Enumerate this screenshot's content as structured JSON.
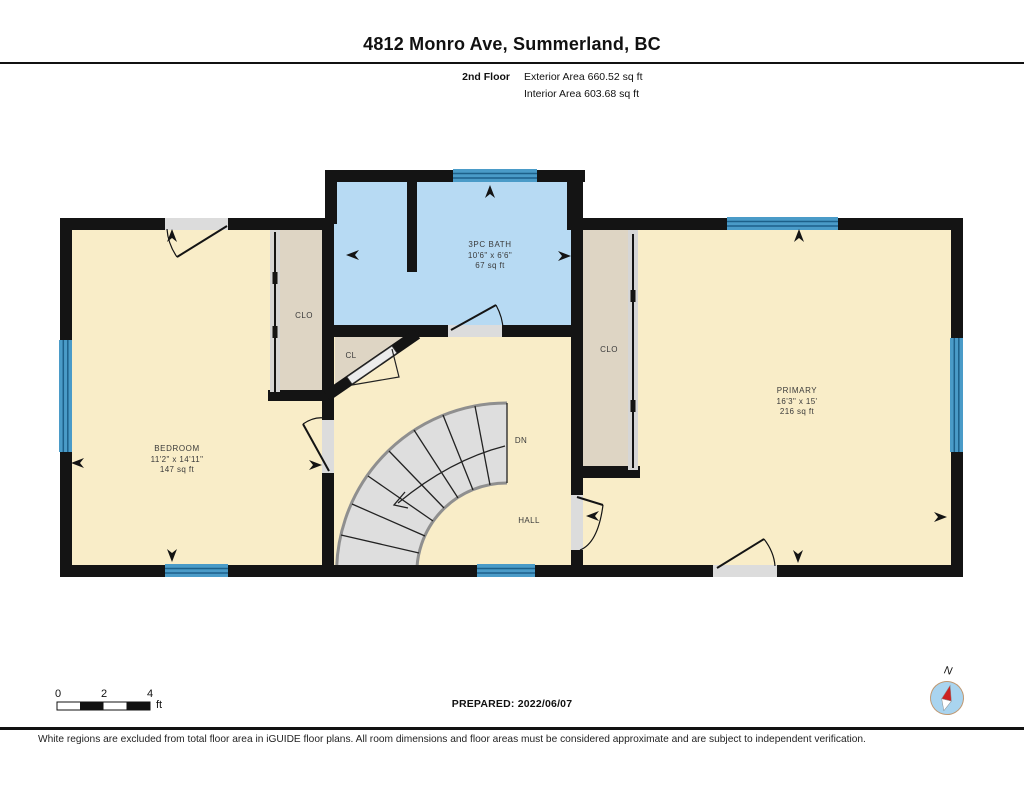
{
  "header": {
    "title": "4812 Monro Ave, Summerland, BC",
    "floor_label": "2nd Floor",
    "exterior_area": "Exterior Area 660.52 sq ft",
    "interior_area": "Interior Area 603.68 sq ft"
  },
  "rooms": {
    "bedroom": {
      "name": "BEDROOM",
      "dims": "11'2\" x 14'11\"",
      "area": "147 sq ft"
    },
    "bath": {
      "name": "3PC BATH",
      "dims": "10'6\" x 6'6\"",
      "area": "67 sq ft"
    },
    "primary": {
      "name": "PRIMARY",
      "dims": "16'3\" x 15'",
      "area": "216 sq ft"
    },
    "closet_left": {
      "name": "CLO"
    },
    "closet_small": {
      "name": "CL"
    },
    "closet_right": {
      "name": "CLO"
    },
    "hall": {
      "name": "HALL"
    },
    "stairs_direction": {
      "name": "DN"
    }
  },
  "scale_bar": {
    "ticks": [
      "0",
      "2",
      "4"
    ],
    "unit": "ft"
  },
  "prepared": "PREPARED: 2022/06/07",
  "compass": {
    "label": "N"
  },
  "footer": {
    "disclaimer": "White regions are excluded from total floor area in iGUIDE floor plans. All room dimensions and floor areas must be considered approximate and are subject to independent verification."
  },
  "colors": {
    "wall": "#141414",
    "room_cream": "#f9edc8",
    "bath_blue": "#b7daf3",
    "closet_tan": "#ded5c4",
    "window_blue": "#4a9bc8",
    "window_stripe": "#1d608a",
    "stair_gray": "#dedede",
    "door_gray": "#dcdcdc",
    "compass_red": "#cc2222",
    "compass_blue": "#a9d4ef"
  }
}
